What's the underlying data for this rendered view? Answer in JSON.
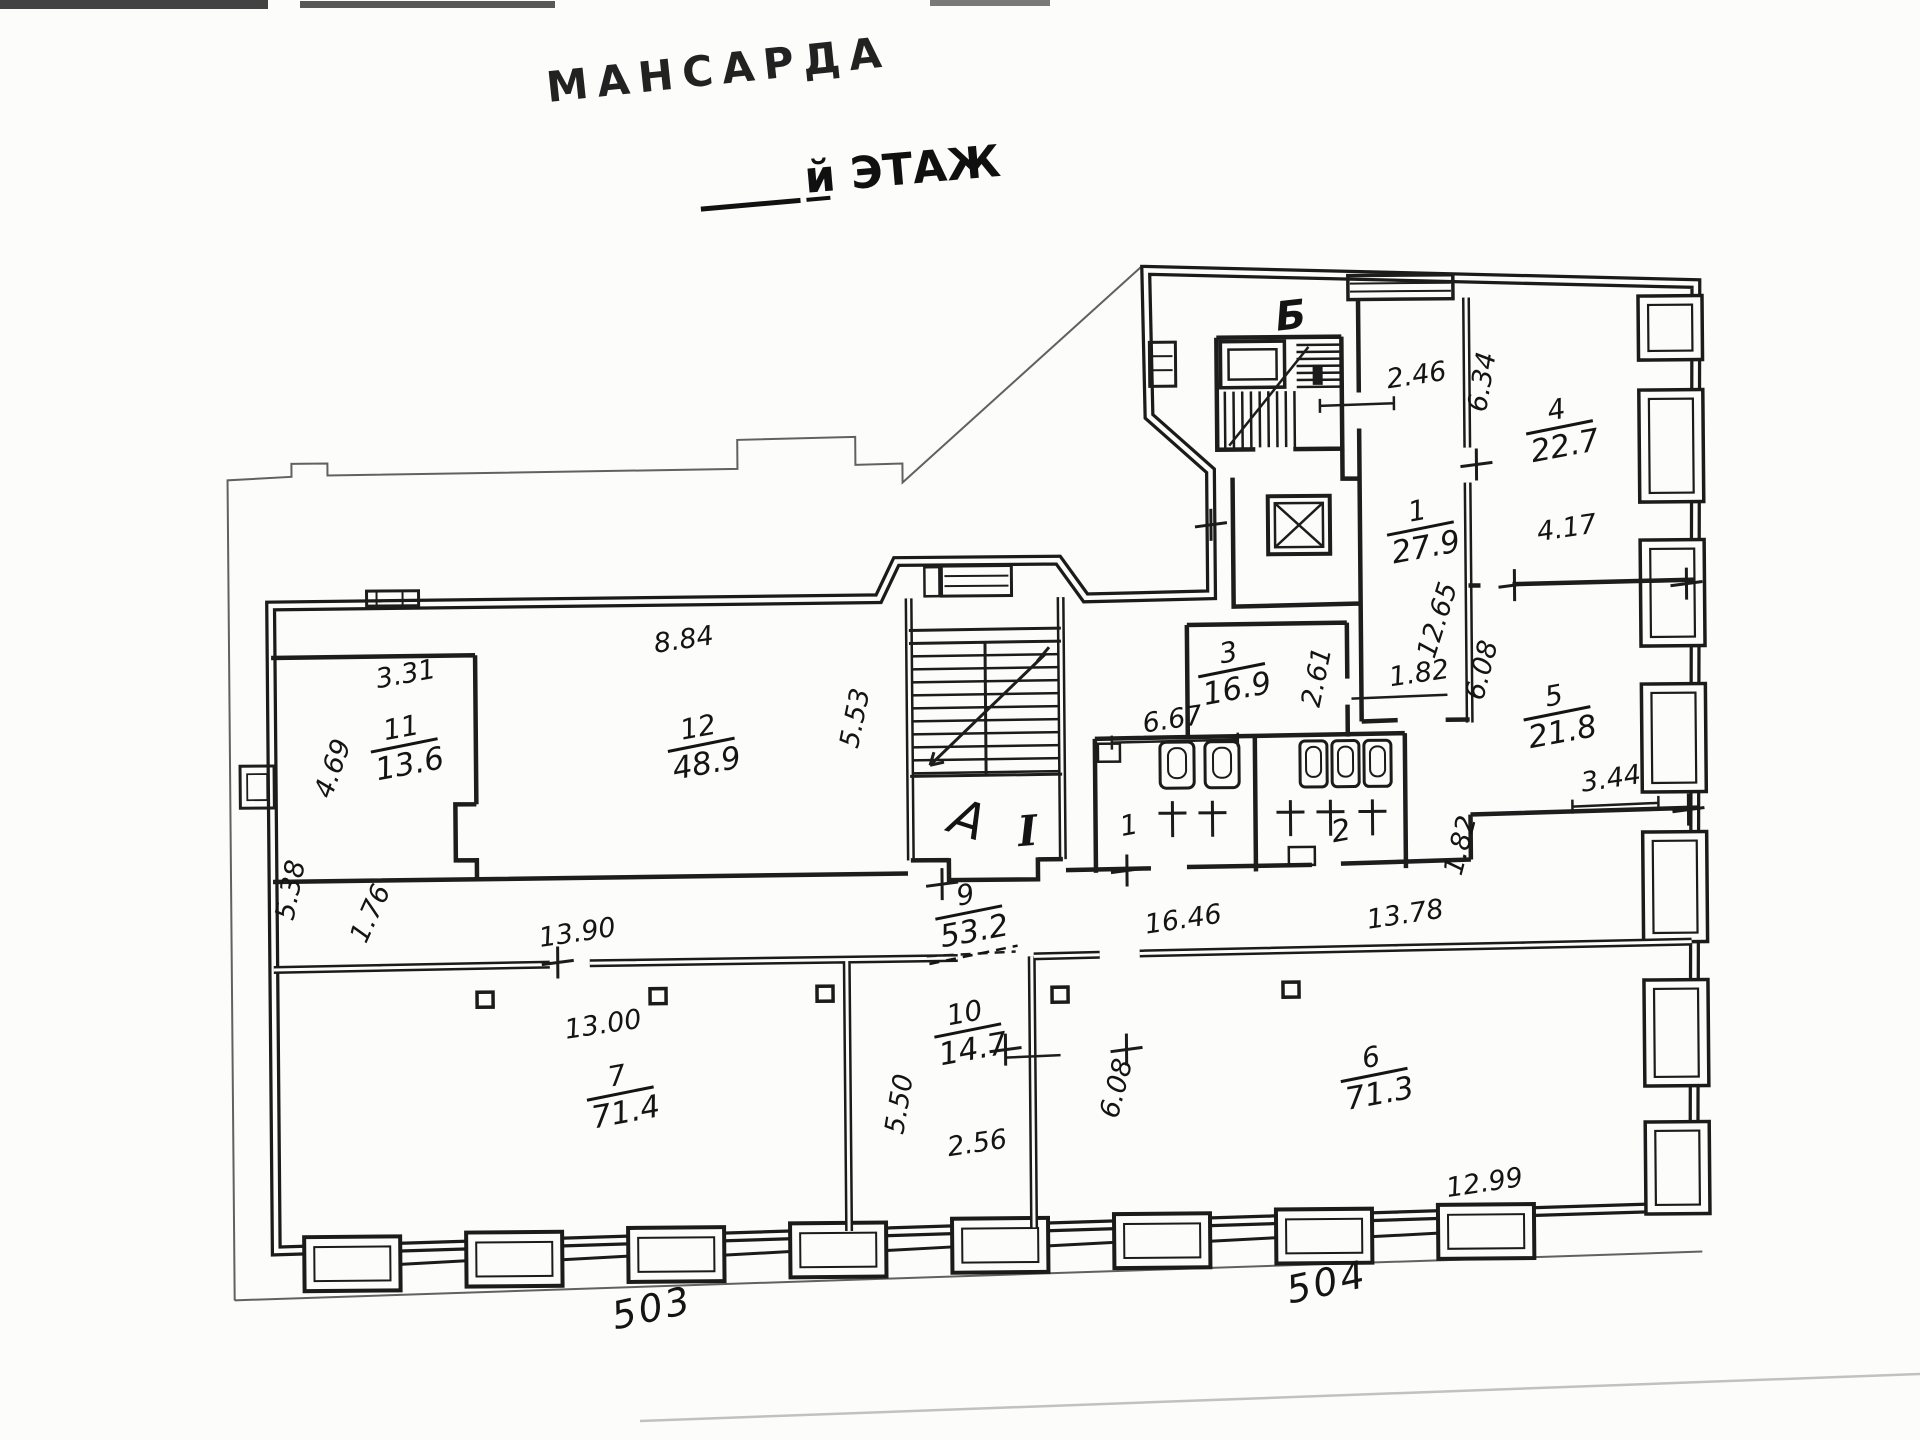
{
  "title": {
    "stamp": "МАНСАРДА",
    "floor_suffix": "й ЭТАЖ"
  },
  "plan": {
    "room_labels": [
      {
        "num": "1",
        "area": "27.9",
        "x": 1423,
        "y": 536,
        "rot": -10
      },
      {
        "num": "3",
        "area": "16.9",
        "x": 1233,
        "y": 676,
        "rot": -10
      },
      {
        "num": "4",
        "area": "22.7",
        "x": 1563,
        "y": 436,
        "rot": -10
      },
      {
        "num": "5",
        "area": "21.8",
        "x": 1558,
        "y": 722,
        "rot": -10
      },
      {
        "num": "6",
        "area": "71.3",
        "x": 1372,
        "y": 1082,
        "rot": -10
      },
      {
        "num": "7",
        "area": "71.4",
        "x": 618,
        "y": 1094,
        "rot": -10
      },
      {
        "num": "9",
        "area": "53.2",
        "x": 968,
        "y": 916,
        "rot": -10,
        "dashed": true
      },
      {
        "num": "10",
        "area": "14.7",
        "x": 966,
        "y": 1034,
        "rot": -10
      },
      {
        "num": "11",
        "area": "13.6",
        "x": 405,
        "y": 744,
        "rot": -10
      },
      {
        "num": "12",
        "area": "48.9",
        "x": 702,
        "y": 746,
        "rot": -10
      }
    ],
    "dim_labels": [
      {
        "t": "2.46",
        "x": 1421,
        "y": 388,
        "r": -8
      },
      {
        "t": "6.34",
        "x": 1494,
        "y": 388,
        "r": -80
      },
      {
        "t": "4.17",
        "x": 1570,
        "y": 542,
        "r": -8
      },
      {
        "t": "3.44",
        "x": 1612,
        "y": 793,
        "r": -8
      },
      {
        "t": "1.82",
        "x": 1468,
        "y": 852,
        "r": -75
      },
      {
        "t": "12.65",
        "x": 1447,
        "y": 627,
        "r": -72
      },
      {
        "t": "6.08",
        "x": 1491,
        "y": 677,
        "r": -75
      },
      {
        "t": "1.82",
        "x": 1421,
        "y": 686,
        "r": -8
      },
      {
        "t": "2.61",
        "x": 1326,
        "y": 682,
        "r": -78
      },
      {
        "t": "6.67",
        "x": 1174,
        "y": 730,
        "r": -8
      },
      {
        "t": "5.53",
        "x": 864,
        "y": 719,
        "r": -78
      },
      {
        "t": "8.84",
        "x": 686,
        "y": 646,
        "r": -8
      },
      {
        "t": "3.31",
        "x": 408,
        "y": 678,
        "r": -10
      },
      {
        "t": "4.69",
        "x": 341,
        "y": 766,
        "r": -70
      },
      {
        "t": "1.76",
        "x": 377,
        "y": 912,
        "r": -65
      },
      {
        "t": "13.90",
        "x": 577,
        "y": 938,
        "r": -8
      },
      {
        "t": "13.00",
        "x": 602,
        "y": 1030,
        "r": -8
      },
      {
        "t": "5.38",
        "x": 298,
        "y": 886,
        "r": -78
      },
      {
        "t": "5.50",
        "x": 905,
        "y": 1105,
        "r": -80
      },
      {
        "t": "2.56",
        "x": 975,
        "y": 1152,
        "r": -8
      },
      {
        "t": "16.46",
        "x": 1183,
        "y": 930,
        "r": -8
      },
      {
        "t": "13.78",
        "x": 1405,
        "y": 927,
        "r": -8
      },
      {
        "t": "6.08",
        "x": 1122,
        "y": 1092,
        "r": -75
      },
      {
        "t": "12.99",
        "x": 1482,
        "y": 1196,
        "r": -8
      }
    ],
    "point_labels": [
      {
        "t": "Б",
        "x": 1296,
        "y": 332,
        "r": -6,
        "size": 40,
        "w": "bold"
      },
      {
        "t": "А",
        "x": 962,
        "y": 836,
        "r": 18,
        "size": 50,
        "w": "normal"
      },
      {
        "t": "I",
        "x": 1028,
        "y": 846,
        "r": -4,
        "size": 42,
        "w": "bold",
        "serif": true
      },
      {
        "t": "1",
        "x": 1130,
        "y": 836,
        "r": -10,
        "size": 28,
        "w": "normal"
      },
      {
        "t": "2",
        "x": 1342,
        "y": 844,
        "r": -10,
        "size": 30,
        "w": "normal"
      }
    ],
    "handwritten": [
      {
        "t": "503",
        "x": 650,
        "y": 1318,
        "r": -12
      },
      {
        "t": "504",
        "x": 1325,
        "y": 1298,
        "r": -12
      }
    ]
  }
}
